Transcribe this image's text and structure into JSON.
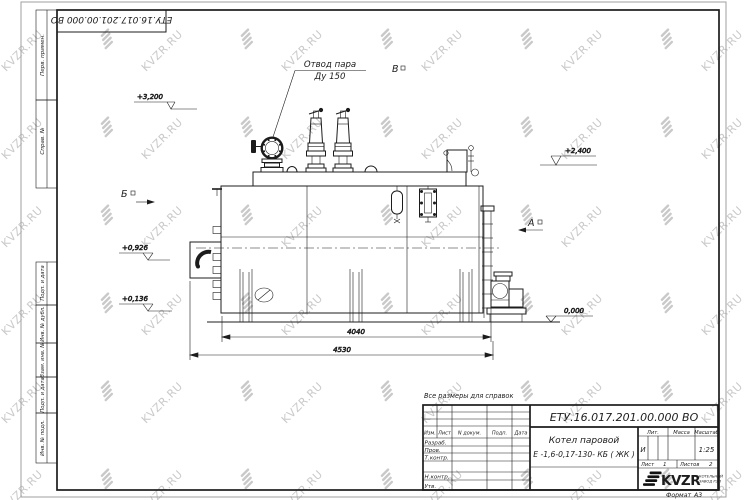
{
  "watermark": {
    "text": "KVZR.RU"
  },
  "corner_stamp": {
    "doc_number": "ЕТУ.16.017.201.00.000  ВО"
  },
  "frame": {
    "perv_primen": "Перв. примен.",
    "sprav_no": "Справ. №",
    "podp_data_top": "Подп. и дата",
    "inv_dubl": "Инв. № дубл.",
    "vzam_inv": "Взам. инв. №",
    "podp_data_bottom": "Подп. и дата",
    "inv_podl": "Инв. № подл.",
    "format_label": "Формат",
    "format_value": "А3"
  },
  "drawing": {
    "note": "Все размеры для справок",
    "steam_outlet_label_1": "Отвод пара",
    "steam_outlet_label_2": "Ду 150",
    "view_a": "А",
    "view_b": "Б",
    "view_v": "В",
    "elev_3200": "+3,200",
    "elev_2400": "+2,400",
    "elev_0926": "+0,926",
    "elev_0136": "+0,136",
    "elev_0000": "0,000",
    "dim_length_inner": "4040",
    "dim_length_outer": "4530"
  },
  "title_block": {
    "doc_number": "ЕТУ.16.017.201.00.000  ВО",
    "product_name_line1": "Котел паровой",
    "product_name_line2": "Е -1,6-0,17-130- КБ ( ЖК )",
    "col_izm": "Изм.",
    "col_list": "Лист",
    "col_ndokum": "N докум.",
    "col_podp": "Подп.",
    "col_data": "Дата",
    "row_razrab": "Разраб.",
    "row_prov": "Пров.",
    "row_tkontr": "Т.контр.",
    "row_nkontr": "Н.контр.",
    "row_utv": "Утв.",
    "lit_label": "Лит.",
    "massa_label": "Масса",
    "masshtab_label": "Масштаб",
    "lit_value": "И",
    "masshtab_value": "1:25",
    "list_label": "Лист",
    "list_value": "1",
    "listov_label": "Листов",
    "listov_value": "2",
    "logo_text": "KVZR",
    "logo_sub_line1": "КОТЕЛЬНЫЙ",
    "logo_sub_line2": "ЗАВОД РЭП"
  }
}
